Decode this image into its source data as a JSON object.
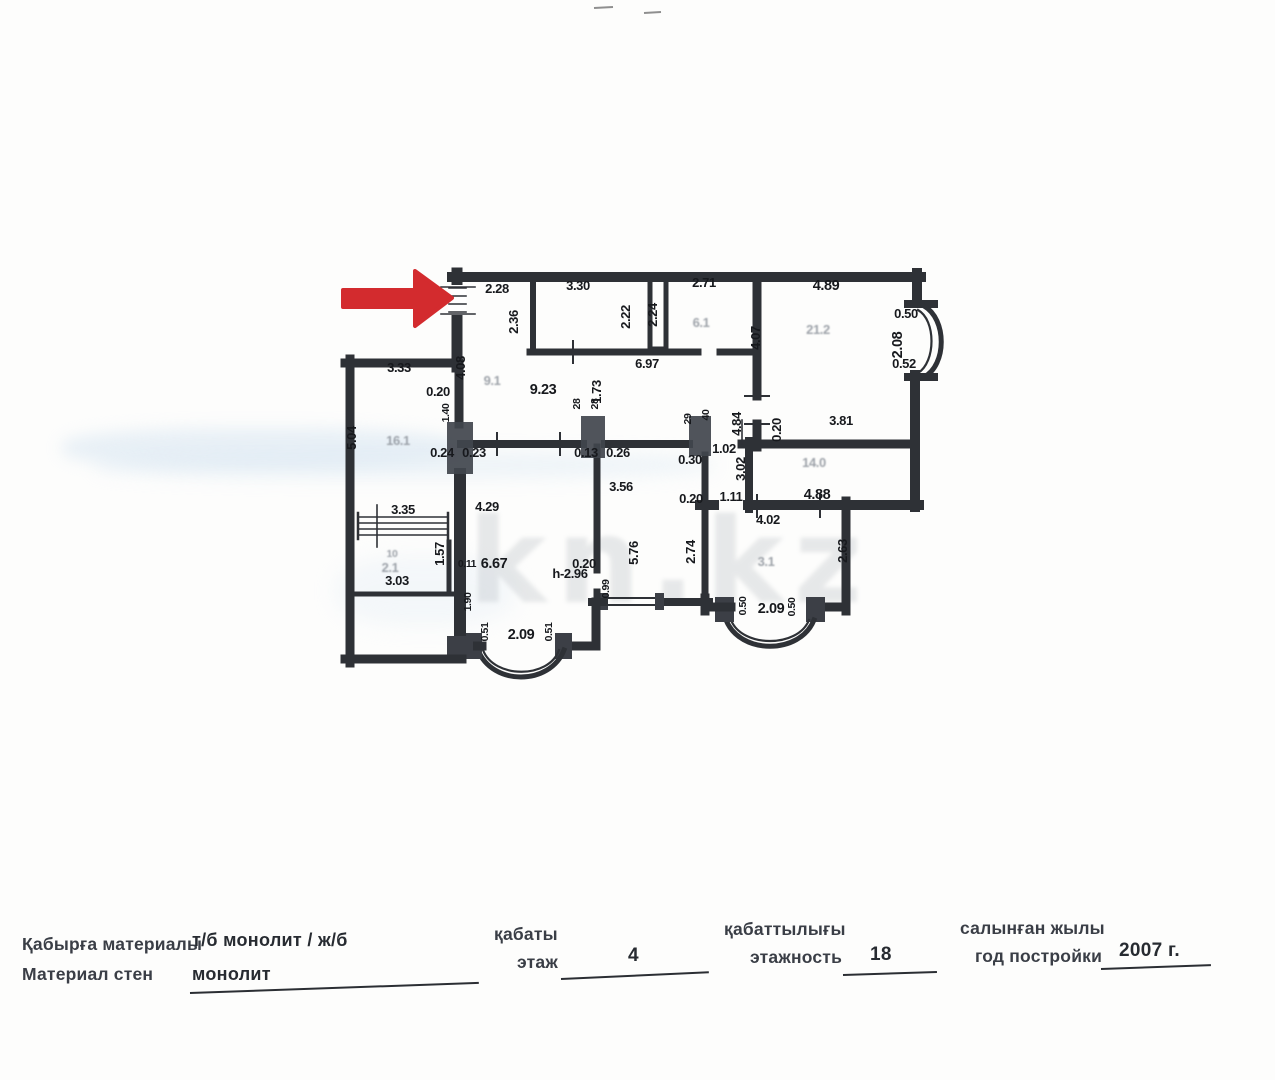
{
  "watermark": "kn.kz",
  "colors": {
    "arrow": "#d32b2e",
    "wall": "#2e3136",
    "wash_blue": "#cfe0ef"
  },
  "floor_plan": {
    "labels": [
      {
        "text": "2.28",
        "x": 497,
        "y": 293
      },
      {
        "text": "3.30",
        "x": 578,
        "y": 290
      },
      {
        "text": "2.71",
        "x": 704,
        "y": 287
      },
      {
        "text": "4.89",
        "x": 826,
        "y": 290,
        "cls": "b"
      },
      {
        "text": "2.36",
        "x": 518,
        "y": 322,
        "rot": -90
      },
      {
        "text": "2.22",
        "x": 630,
        "y": 317,
        "rot": -90
      },
      {
        "text": "2.24",
        "x": 657,
        "y": 315,
        "rot": -90
      },
      {
        "text": "6.1",
        "x": 701,
        "y": 327,
        "cls": "f"
      },
      {
        "text": "4.07",
        "x": 760,
        "y": 338,
        "rot": -90
      },
      {
        "text": "21.2",
        "x": 818,
        "y": 334,
        "cls": "f"
      },
      {
        "text": "0.50",
        "x": 906,
        "y": 318
      },
      {
        "text": "2.08",
        "x": 902,
        "y": 345,
        "rot": -90,
        "cls": "b"
      },
      {
        "text": "0.52",
        "x": 904,
        "y": 368
      },
      {
        "text": "6.97",
        "x": 647,
        "y": 368
      },
      {
        "text": "4.08",
        "x": 465,
        "y": 368,
        "rot": -90
      },
      {
        "text": "3.33",
        "x": 399,
        "y": 372
      },
      {
        "text": "0.20",
        "x": 438,
        "y": 396
      },
      {
        "text": "9.1",
        "x": 492,
        "y": 385,
        "cls": "f"
      },
      {
        "text": "9.23",
        "x": 543,
        "y": 394,
        "cls": "b"
      },
      {
        "text": "1.73",
        "x": 601,
        "y": 392,
        "rot": -90
      },
      {
        "text": "1.40",
        "x": 449,
        "y": 413,
        "rot": -90,
        "cls": "s"
      },
      {
        "text": "5.04",
        "x": 356,
        "y": 438,
        "rot": -90
      },
      {
        "text": "16.1",
        "x": 398,
        "y": 445,
        "cls": "f"
      },
      {
        "text": "0.24",
        "x": 442,
        "y": 457
      },
      {
        "text": "0.23",
        "x": 474,
        "y": 457
      },
      {
        "text": "28",
        "x": 580,
        "y": 404,
        "rot": -90,
        "cls": "s"
      },
      {
        "text": "28",
        "x": 598,
        "y": 404,
        "rot": -90,
        "cls": "s"
      },
      {
        "text": "29",
        "x": 691,
        "y": 419,
        "rot": -90,
        "cls": "s"
      },
      {
        "text": "40",
        "x": 709,
        "y": 415,
        "rot": -90,
        "cls": "s"
      },
      {
        "text": "0.13",
        "x": 586,
        "y": 457
      },
      {
        "text": "0.26",
        "x": 618,
        "y": 457
      },
      {
        "text": "0.30",
        "x": 690,
        "y": 464
      },
      {
        "text": "1.02",
        "x": 724,
        "y": 453
      },
      {
        "text": "3.02",
        "x": 745,
        "y": 469,
        "rot": -90
      },
      {
        "text": "4.84",
        "x": 741,
        "y": 424,
        "rot": -90
      },
      {
        "text": "0.20",
        "x": 781,
        "y": 430,
        "rot": -90
      },
      {
        "text": "3.81",
        "x": 841,
        "y": 425
      },
      {
        "text": "14.0",
        "x": 814,
        "y": 467,
        "cls": "f"
      },
      {
        "text": "4.88",
        "x": 817,
        "y": 499,
        "cls": "b"
      },
      {
        "text": "3.56",
        "x": 621,
        "y": 491
      },
      {
        "text": "4.29",
        "x": 487,
        "y": 511
      },
      {
        "text": "3.35",
        "x": 403,
        "y": 514
      },
      {
        "text": "1.57",
        "x": 444,
        "y": 554,
        "rot": -90
      },
      {
        "text": "10",
        "x": 392,
        "y": 557,
        "cls": "f s"
      },
      {
        "text": "2.1",
        "x": 390,
        "y": 572,
        "cls": "f"
      },
      {
        "text": "3.03",
        "x": 397,
        "y": 585
      },
      {
        "text": "0.11",
        "x": 467,
        "y": 567,
        "cls": "s"
      },
      {
        "text": "6.67",
        "x": 494,
        "y": 568,
        "cls": "b"
      },
      {
        "text": "1.90",
        "x": 471,
        "y": 602,
        "rot": -90,
        "cls": "s"
      },
      {
        "text": "0.20",
        "x": 584,
        "y": 568
      },
      {
        "text": "5.76",
        "x": 638,
        "y": 553,
        "rot": -90
      },
      {
        "text": "0.99",
        "x": 609,
        "y": 589,
        "rot": -90,
        "cls": "s"
      },
      {
        "text": "2.74",
        "x": 695,
        "y": 552,
        "rot": -90
      },
      {
        "text": "0.20",
        "x": 691,
        "y": 503
      },
      {
        "text": "1.11",
        "x": 731,
        "y": 501
      },
      {
        "text": "4.02",
        "x": 768,
        "y": 524
      },
      {
        "text": "3.1",
        "x": 766,
        "y": 566,
        "cls": "f"
      },
      {
        "text": "2.63",
        "x": 847,
        "y": 551,
        "rot": -90
      },
      {
        "text": "h-2.96",
        "x": 570,
        "y": 578
      },
      {
        "text": "0.51",
        "x": 488,
        "y": 632,
        "rot": -90,
        "cls": "s"
      },
      {
        "text": "2.09",
        "x": 521,
        "y": 639,
        "cls": "b"
      },
      {
        "text": "0.51",
        "x": 552,
        "y": 632,
        "rot": -90,
        "cls": "s"
      },
      {
        "text": "0.50",
        "x": 746,
        "y": 606,
        "rot": -90,
        "cls": "s"
      },
      {
        "text": "2.09",
        "x": 771,
        "y": 613,
        "cls": "b"
      },
      {
        "text": "0.50",
        "x": 795,
        "y": 607,
        "rot": -90,
        "cls": "s"
      }
    ]
  },
  "info_fields": [
    {
      "label_kk": "Қабырға материалы",
      "label_ru": "Материал стен",
      "value_line1": "т/б монолит / ж/б",
      "value_line2": "монолит"
    },
    {
      "label_kk": "қабаты",
      "label_ru": "этаж",
      "value": "4"
    },
    {
      "label_kk": "қабаттылығы",
      "label_ru": "этажность",
      "value": "18"
    },
    {
      "label_kk": "салынған жылы",
      "label_ru": "год постройки",
      "value": "2007 г."
    }
  ]
}
